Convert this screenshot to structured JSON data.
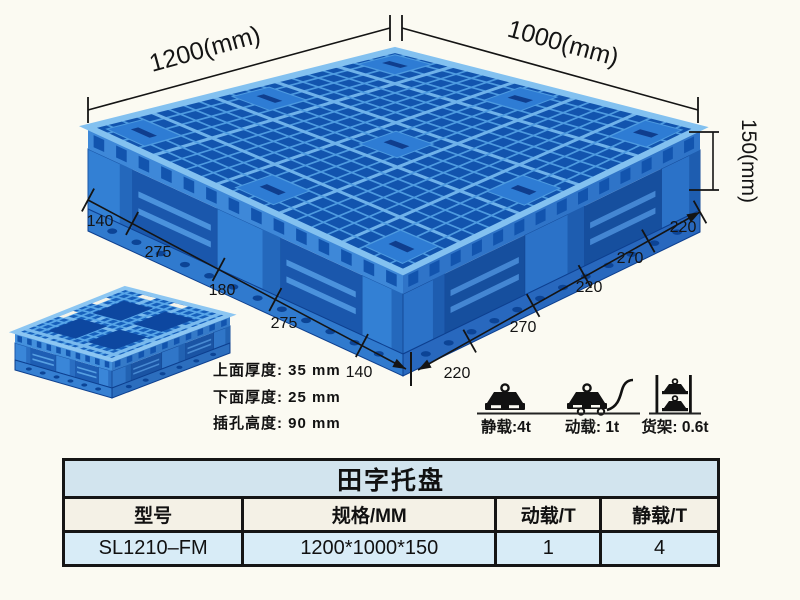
{
  "illustration": {
    "dims": {
      "top_left": "1200(mm)",
      "top_right": "1000(mm)",
      "height": "150(mm)"
    },
    "left_segments": [
      "140",
      "275",
      "180",
      "275",
      "140"
    ],
    "right_segments": [
      "220",
      "270",
      "220",
      "270",
      "220"
    ],
    "thickness": [
      "上面厚度: 35 mm",
      "下面厚度: 25 mm",
      "插孔高度: 90 mm"
    ],
    "loads": [
      {
        "icon": "static-load-weight-icon",
        "label": "静载:4t"
      },
      {
        "icon": "dynamic-load-trolley-icon",
        "label": "动载: 1t"
      },
      {
        "icon": "rack-load-shelf-icon",
        "label": "货架: 0.6t"
      }
    ]
  },
  "table": {
    "title": "田字托盘",
    "headers": [
      "型号",
      "规格/MM",
      "动载/T",
      "静载/T"
    ],
    "rows": [
      [
        "SL1210–FM",
        "1200*1000*150",
        "1",
        "4"
      ]
    ]
  },
  "colors": {
    "pallet_blue": "#2F7CCE",
    "pallet_dark_blue": "#1254AE",
    "pallet_light_rib": "#6FB2EA",
    "background": "#FBFAF2",
    "table_title_bg": "#D2E4EE",
    "table_header_bg": "#F4F1E6",
    "table_row_bg": "#D8ECF7",
    "line_color": "#141414"
  }
}
